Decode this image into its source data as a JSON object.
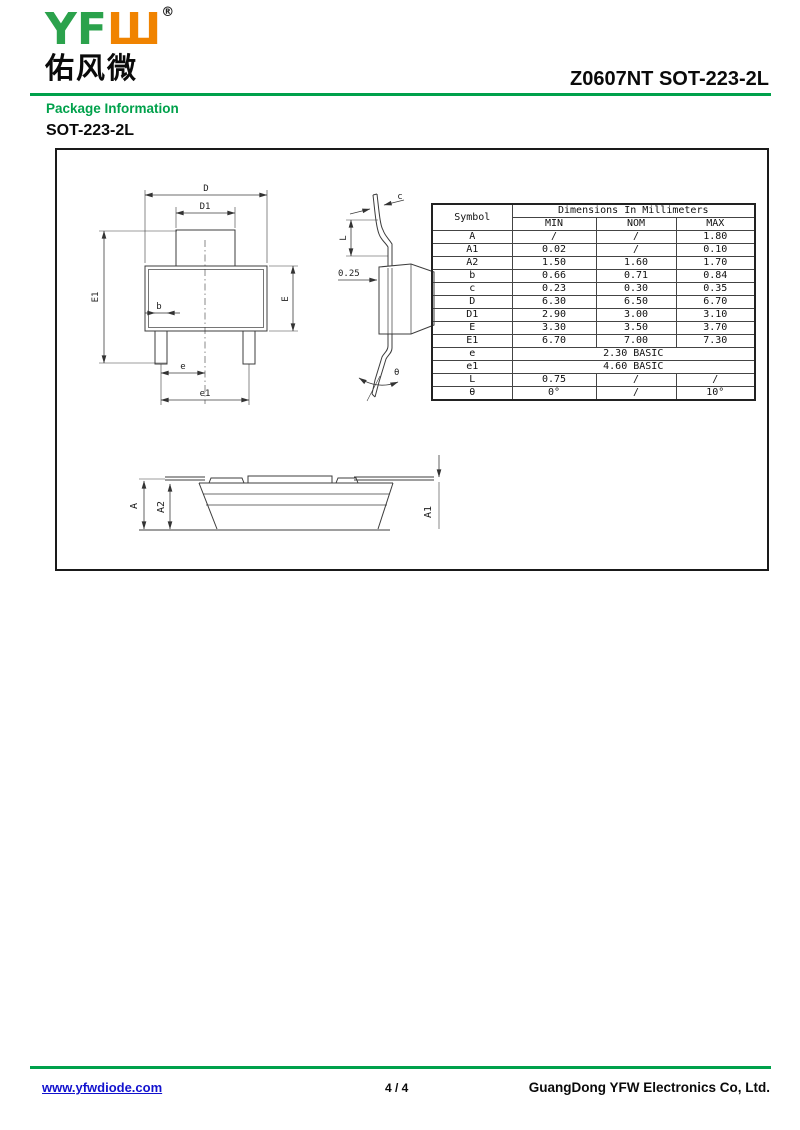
{
  "header": {
    "logo": {
      "yf": "YF",
      "w": "Ш",
      "registered": "®",
      "chinese": "佑风微",
      "green": "#2BA24C",
      "orange": "#F08300"
    },
    "doc_title": "Z0607NT SOT-223-2L",
    "section_label": "Package Information",
    "package_name": "SOT-223-2L",
    "rule_color": "#00A14B"
  },
  "drawing": {
    "labels": {
      "D": "D",
      "D1": "D1",
      "E1": "E1",
      "E": "E",
      "b": "b",
      "e": "e",
      "e1": "e1",
      "c": "c",
      "L": "L",
      "s025": "0.25",
      "theta": "θ",
      "A": "A",
      "A2": "A2",
      "A1": "A1"
    }
  },
  "table": {
    "symbol_header": "Symbol",
    "title": "Dimensions In Millimeters",
    "col_headers": [
      "MIN",
      "NOM",
      "MAX"
    ],
    "rows": [
      {
        "symbol": "A",
        "min": "/",
        "nom": "/",
        "max": "1.80"
      },
      {
        "symbol": "A1",
        "min": "0.02",
        "nom": "/",
        "max": "0.10"
      },
      {
        "symbol": "A2",
        "min": "1.50",
        "nom": "1.60",
        "max": "1.70"
      },
      {
        "symbol": "b",
        "min": "0.66",
        "nom": "0.71",
        "max": "0.84"
      },
      {
        "symbol": "c",
        "min": "0.23",
        "nom": "0.30",
        "max": "0.35"
      },
      {
        "symbol": "D",
        "min": "6.30",
        "nom": "6.50",
        "max": "6.70"
      },
      {
        "symbol": "D1",
        "min": "2.90",
        "nom": "3.00",
        "max": "3.10"
      },
      {
        "symbol": "E",
        "min": "3.30",
        "nom": "3.50",
        "max": "3.70"
      },
      {
        "symbol": "E1",
        "min": "6.70",
        "nom": "7.00",
        "max": "7.30"
      },
      {
        "symbol": "e",
        "span": "2.30 BASIC"
      },
      {
        "symbol": "e1",
        "span": "4.60 BASIC"
      },
      {
        "symbol": "L",
        "min": "0.75",
        "nom": "/",
        "max": "/"
      },
      {
        "symbol": "θ",
        "min": "0°",
        "nom": "/",
        "max": "10°"
      }
    ]
  },
  "footer": {
    "website": "www.yfwdiode.com",
    "page_number": "4 / 4",
    "company": "GuangDong YFW Electronics Co, Ltd."
  }
}
